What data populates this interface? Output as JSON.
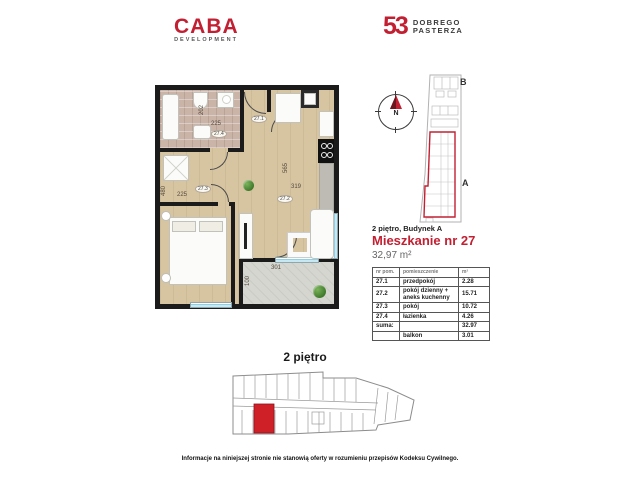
{
  "colors": {
    "accent_red": "#c22032",
    "wall_black": "#1b1b1b",
    "floor_beige": "#d7c5a2",
    "bath_tile": "#c9b4a7",
    "balcony_concrete": "#d6d6d1",
    "window_blue": "#8fd0e4"
  },
  "header": {
    "brand_name": "CABA",
    "brand_subtitle": "DEVELOPMENT",
    "project_number": "53",
    "project_name_line1": "DOBREGO",
    "project_name_line2": "PASTERZA"
  },
  "floorplan": {
    "dims": {
      "bath_h": "202",
      "bath_w": "225",
      "bed_h": "480",
      "bed_w": "225",
      "living_h": "565",
      "living_w": "319",
      "balcony_w": "301",
      "balcony_h": "100"
    },
    "tags": {
      "hall": "27.1",
      "living": "27.2",
      "bedroom": "27.3",
      "bath": "27.4"
    }
  },
  "site": {
    "north": "N",
    "section_b": "B",
    "section_a": "A"
  },
  "info": {
    "location": "2 piętro, Budynek A",
    "title": "Mieszkanie nr 27",
    "area": "32,97 m²"
  },
  "table": {
    "headers": [
      "nr pom.",
      "pomieszczenie",
      "m²"
    ],
    "rows": [
      {
        "nr": "27.1",
        "name": "przedpokój",
        "area": "2.28"
      },
      {
        "nr": "27.2",
        "name": "pokój dzienny + aneks kuchenny",
        "area": "15.71"
      },
      {
        "nr": "27.3",
        "name": "pokój",
        "area": "10.72"
      },
      {
        "nr": "27.4",
        "name": "łazienka",
        "area": "4.26"
      }
    ],
    "sum_label": "suma:",
    "sum_value": "32.97",
    "balcony_name": "balkon",
    "balcony_area": "3.01"
  },
  "overview": {
    "title": "2 piętro"
  },
  "footer": {
    "disclaimer": "Informacje na niniejszej stronie nie stanowią oferty w rozumieniu przepisów Kodeksu Cywilnego."
  }
}
